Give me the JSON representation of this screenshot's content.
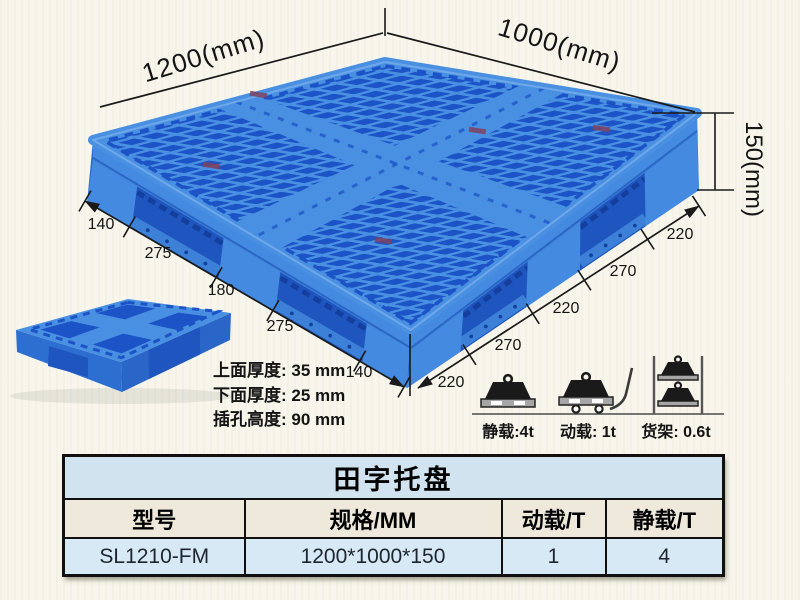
{
  "diagram": {
    "dim_width_label": "1200(mm)",
    "dim_depth_label": "1000(mm)",
    "dim_height_label": "150(mm)",
    "left_edge_dims": [
      "140",
      "275",
      "180",
      "275",
      "140"
    ],
    "right_edge_dims": [
      "220",
      "270",
      "220",
      "270",
      "220"
    ],
    "thickness_notes": [
      "上面厚度: 35 mm",
      "下面厚度: 25 mm",
      "插孔高度: 90 mm"
    ],
    "load_ratings": [
      {
        "icon": "static-load-icon",
        "label": "静载:4t"
      },
      {
        "icon": "dynamic-load-icon",
        "label": "动载: 1t"
      },
      {
        "icon": "rack-load-icon",
        "label": "货架: 0.6t"
      }
    ]
  },
  "colors": {
    "background": "#f8f6ec",
    "pallet_blue": "#4990e2",
    "hole_blue": "#1c53c6",
    "wall_blue": "#2d6fd0",
    "wall_light_blue": "#438ae0",
    "wall_dark_blue": "#1e55be",
    "rail_blue": "#3c80d8",
    "line_black": "#1a1a1a",
    "table_title_bg": "#d0e3ee",
    "table_header_bg": "#eee9db",
    "table_row_bg": "#d7e9f4"
  },
  "table": {
    "title": "田字托盘",
    "headers": [
      "型号",
      "规格/MM",
      "动载/T",
      "静载/T"
    ],
    "rows": [
      {
        "model": "SL1210-FM",
        "spec": "1200*1000*150",
        "dynamic_load": "1",
        "static_load": "4"
      }
    ]
  }
}
